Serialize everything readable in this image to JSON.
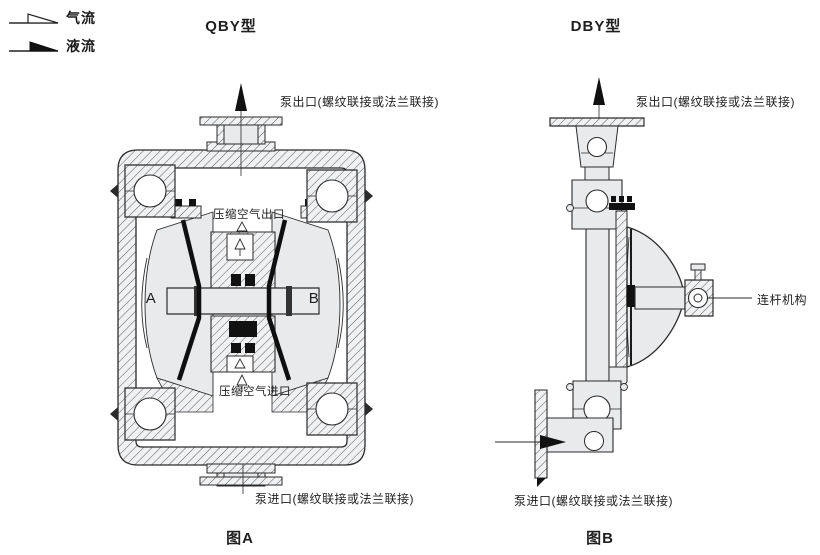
{
  "legend": {
    "air_flow": "气流",
    "liquid_flow": "液流"
  },
  "figure_a": {
    "title": "QBY型",
    "caption": "图A",
    "outlet_label": "泵出口(螺纹联接或法兰联接)",
    "air_outlet_label": "压缩空气出口",
    "air_inlet_label": "压缩空气进口",
    "inlet_label": "泵进口(螺纹联接或法兰联接)",
    "chamber_left": "A",
    "chamber_right": "B"
  },
  "figure_b": {
    "title": "DBY型",
    "caption": "图B",
    "outlet_label": "泵出口(螺纹联接或法兰联接)",
    "inlet_label": "泵进口(螺纹联接或法兰联接)",
    "linkage_label": "连杆机构"
  },
  "colors": {
    "line": "#2b2b2b",
    "metal_fill": "#e8eaec",
    "solid_black": "#111111",
    "background": "#ffffff"
  }
}
